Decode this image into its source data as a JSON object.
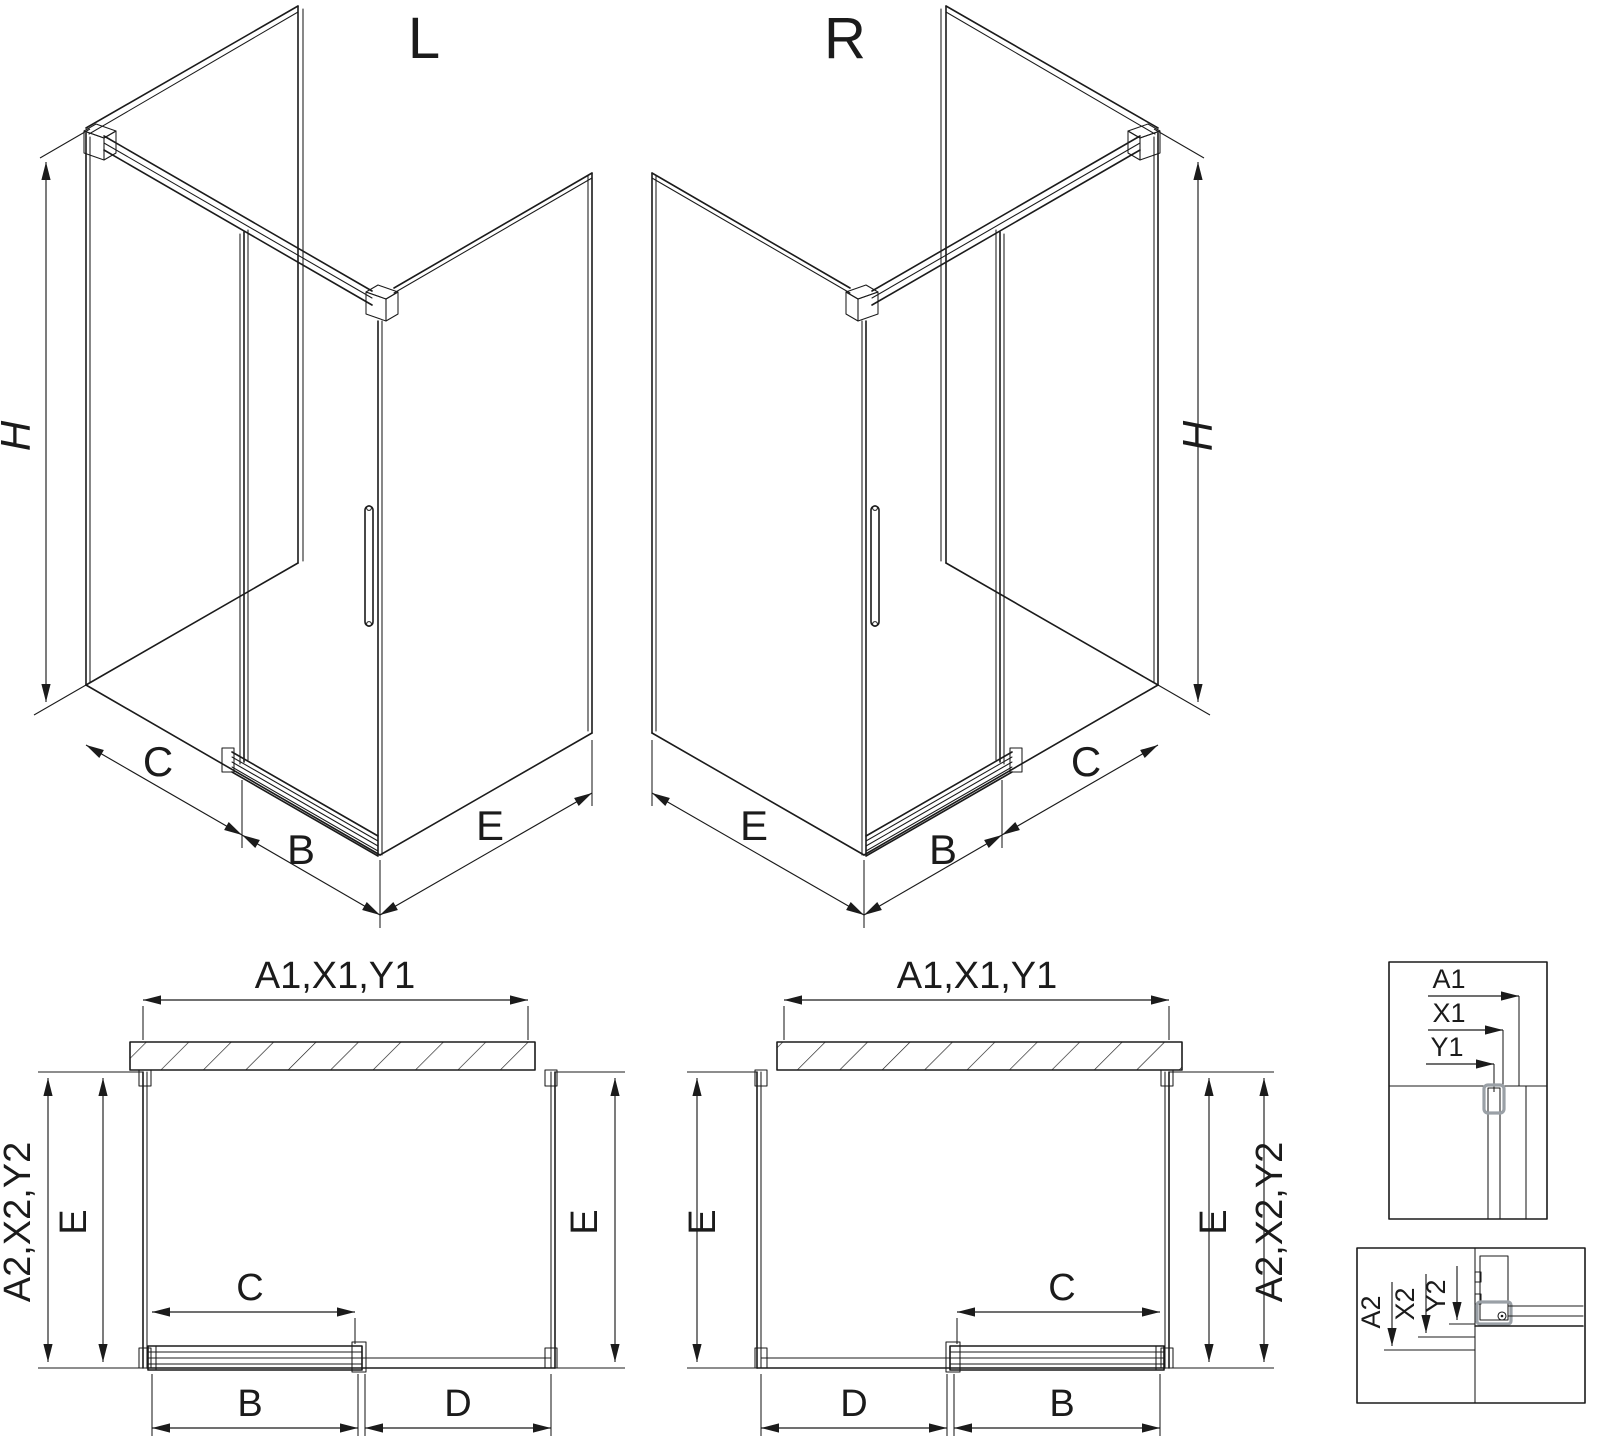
{
  "drawing_title": "Corner sliding-door shower enclosure dimensional drawing",
  "colors": {
    "line": "#1b1b1b",
    "profile_gray": "#9aa0a6",
    "background": "#ffffff"
  },
  "iso_left": {
    "variant": "L",
    "dim_height": "H",
    "dim_front_left": "C",
    "dim_front_right": "B",
    "dim_side": "E"
  },
  "iso_right": {
    "variant": "R",
    "dim_height": "H",
    "dim_front_left": "C",
    "dim_front_right": "B",
    "dim_side": "E"
  },
  "plan_left": {
    "dim_top": "A1,X1,Y1",
    "dim_side_outer": "A2,X2,Y2",
    "dim_left": "E",
    "dim_right": "E",
    "dim_door": "C",
    "dim_bottom_left": "B",
    "dim_bottom_right": "D"
  },
  "plan_right": {
    "dim_top": "A1,X1,Y1",
    "dim_side_outer": "A2,X2,Y2",
    "dim_left": "E",
    "dim_right": "E",
    "dim_door": "C",
    "dim_bottom_left": "D",
    "dim_bottom_right": "B"
  },
  "detail_top": {
    "dim_1": "A1",
    "dim_2": "X1",
    "dim_3": "Y1"
  },
  "detail_bottom": {
    "dim_1": "A2",
    "dim_2": "X2",
    "dim_3": "Y2"
  }
}
